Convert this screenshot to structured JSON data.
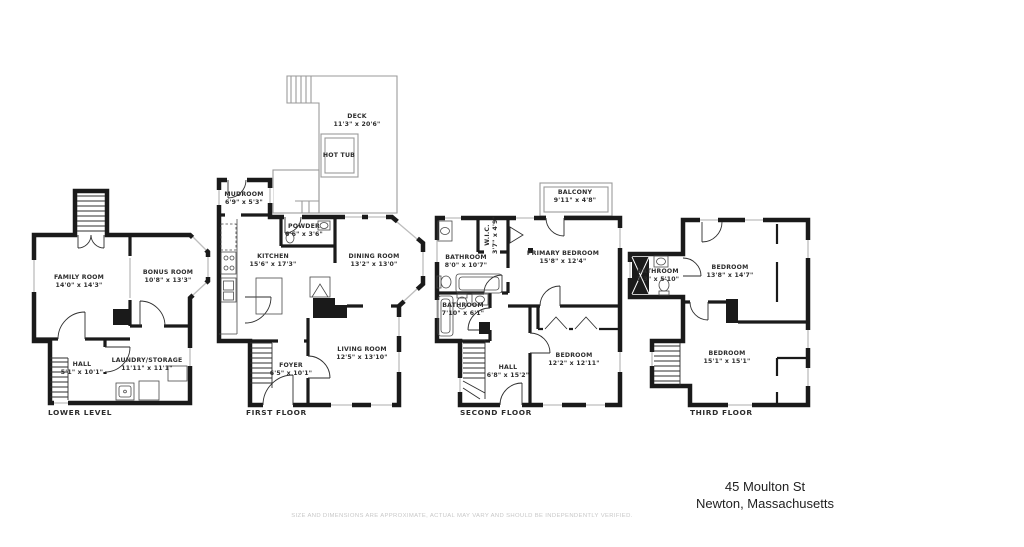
{
  "page": {
    "background": "#ffffff"
  },
  "address": {
    "line1": "45 Moulton St",
    "line2": "Newton, Massachusetts"
  },
  "disclaimer": "SIZE AND DIMENSIONS ARE APPROXIMATE, ACTUAL MAY VARY AND SHOULD BE INDEPENDENTLY VERIFIED.",
  "colors": {
    "walls": "#1a1a1a",
    "windows": "#bdbdbd",
    "deck_outline": "#9a9a9a",
    "label_text": "#2d2d2d",
    "disclaimer_text": "#c8c8c8"
  },
  "floors": [
    {
      "title": "LOWER LEVEL",
      "rooms": [
        {
          "name": "FAMILY ROOM",
          "dims": "14'0\" x 14'3\""
        },
        {
          "name": "BONUS ROOM",
          "dims": "10'8\" x 13'3\""
        },
        {
          "name": "HALL",
          "dims": "5'1\" x 10'1\""
        },
        {
          "name": "LAUNDRY/STORAGE",
          "dims": "11'11\" x 11'1\""
        }
      ]
    },
    {
      "title": "FIRST FLOOR",
      "rooms": [
        {
          "name": "DECK",
          "dims": "11'3\" x 20'6\""
        },
        {
          "name": "HOT TUB",
          "dims": ""
        },
        {
          "name": "MUDROOM",
          "dims": "6'9\" x 5'3\""
        },
        {
          "name": "POWDER",
          "dims": "6'6\" x 3'6\""
        },
        {
          "name": "KITCHEN",
          "dims": "15'6\" x 17'3\""
        },
        {
          "name": "DINING ROOM",
          "dims": "13'2\" x 13'0\""
        },
        {
          "name": "LIVING ROOM",
          "dims": "12'5\" x 13'10\""
        },
        {
          "name": "FOYER",
          "dims": "6'5\" x 10'1\""
        }
      ]
    },
    {
      "title": "SECOND FLOOR",
      "rooms": [
        {
          "name": "BALCONY",
          "dims": "9'11\" x 4'8\""
        },
        {
          "name": "W.I.C.",
          "dims": "3'7\" x 4'9\""
        },
        {
          "name": "BATHROOM",
          "dims": "8'0\" x 10'7\""
        },
        {
          "name": "PRIMARY BEDROOM",
          "dims": "15'8\" x 12'4\""
        },
        {
          "name": "BATHROOM",
          "dims": "7'10\" x 6'1\""
        },
        {
          "name": "HALL",
          "dims": "6'8\" x 15'2\""
        },
        {
          "name": "BEDROOM",
          "dims": "12'2\" x 12'11\""
        }
      ]
    },
    {
      "title": "THIRD FLOOR",
      "rooms": [
        {
          "name": "BATHROOM",
          "dims": "7'3\" x 5'10\""
        },
        {
          "name": "BEDROOM",
          "dims": "13'8\" x 14'7\""
        },
        {
          "name": "BEDROOM",
          "dims": "15'1\" x 15'1\""
        }
      ]
    }
  ]
}
